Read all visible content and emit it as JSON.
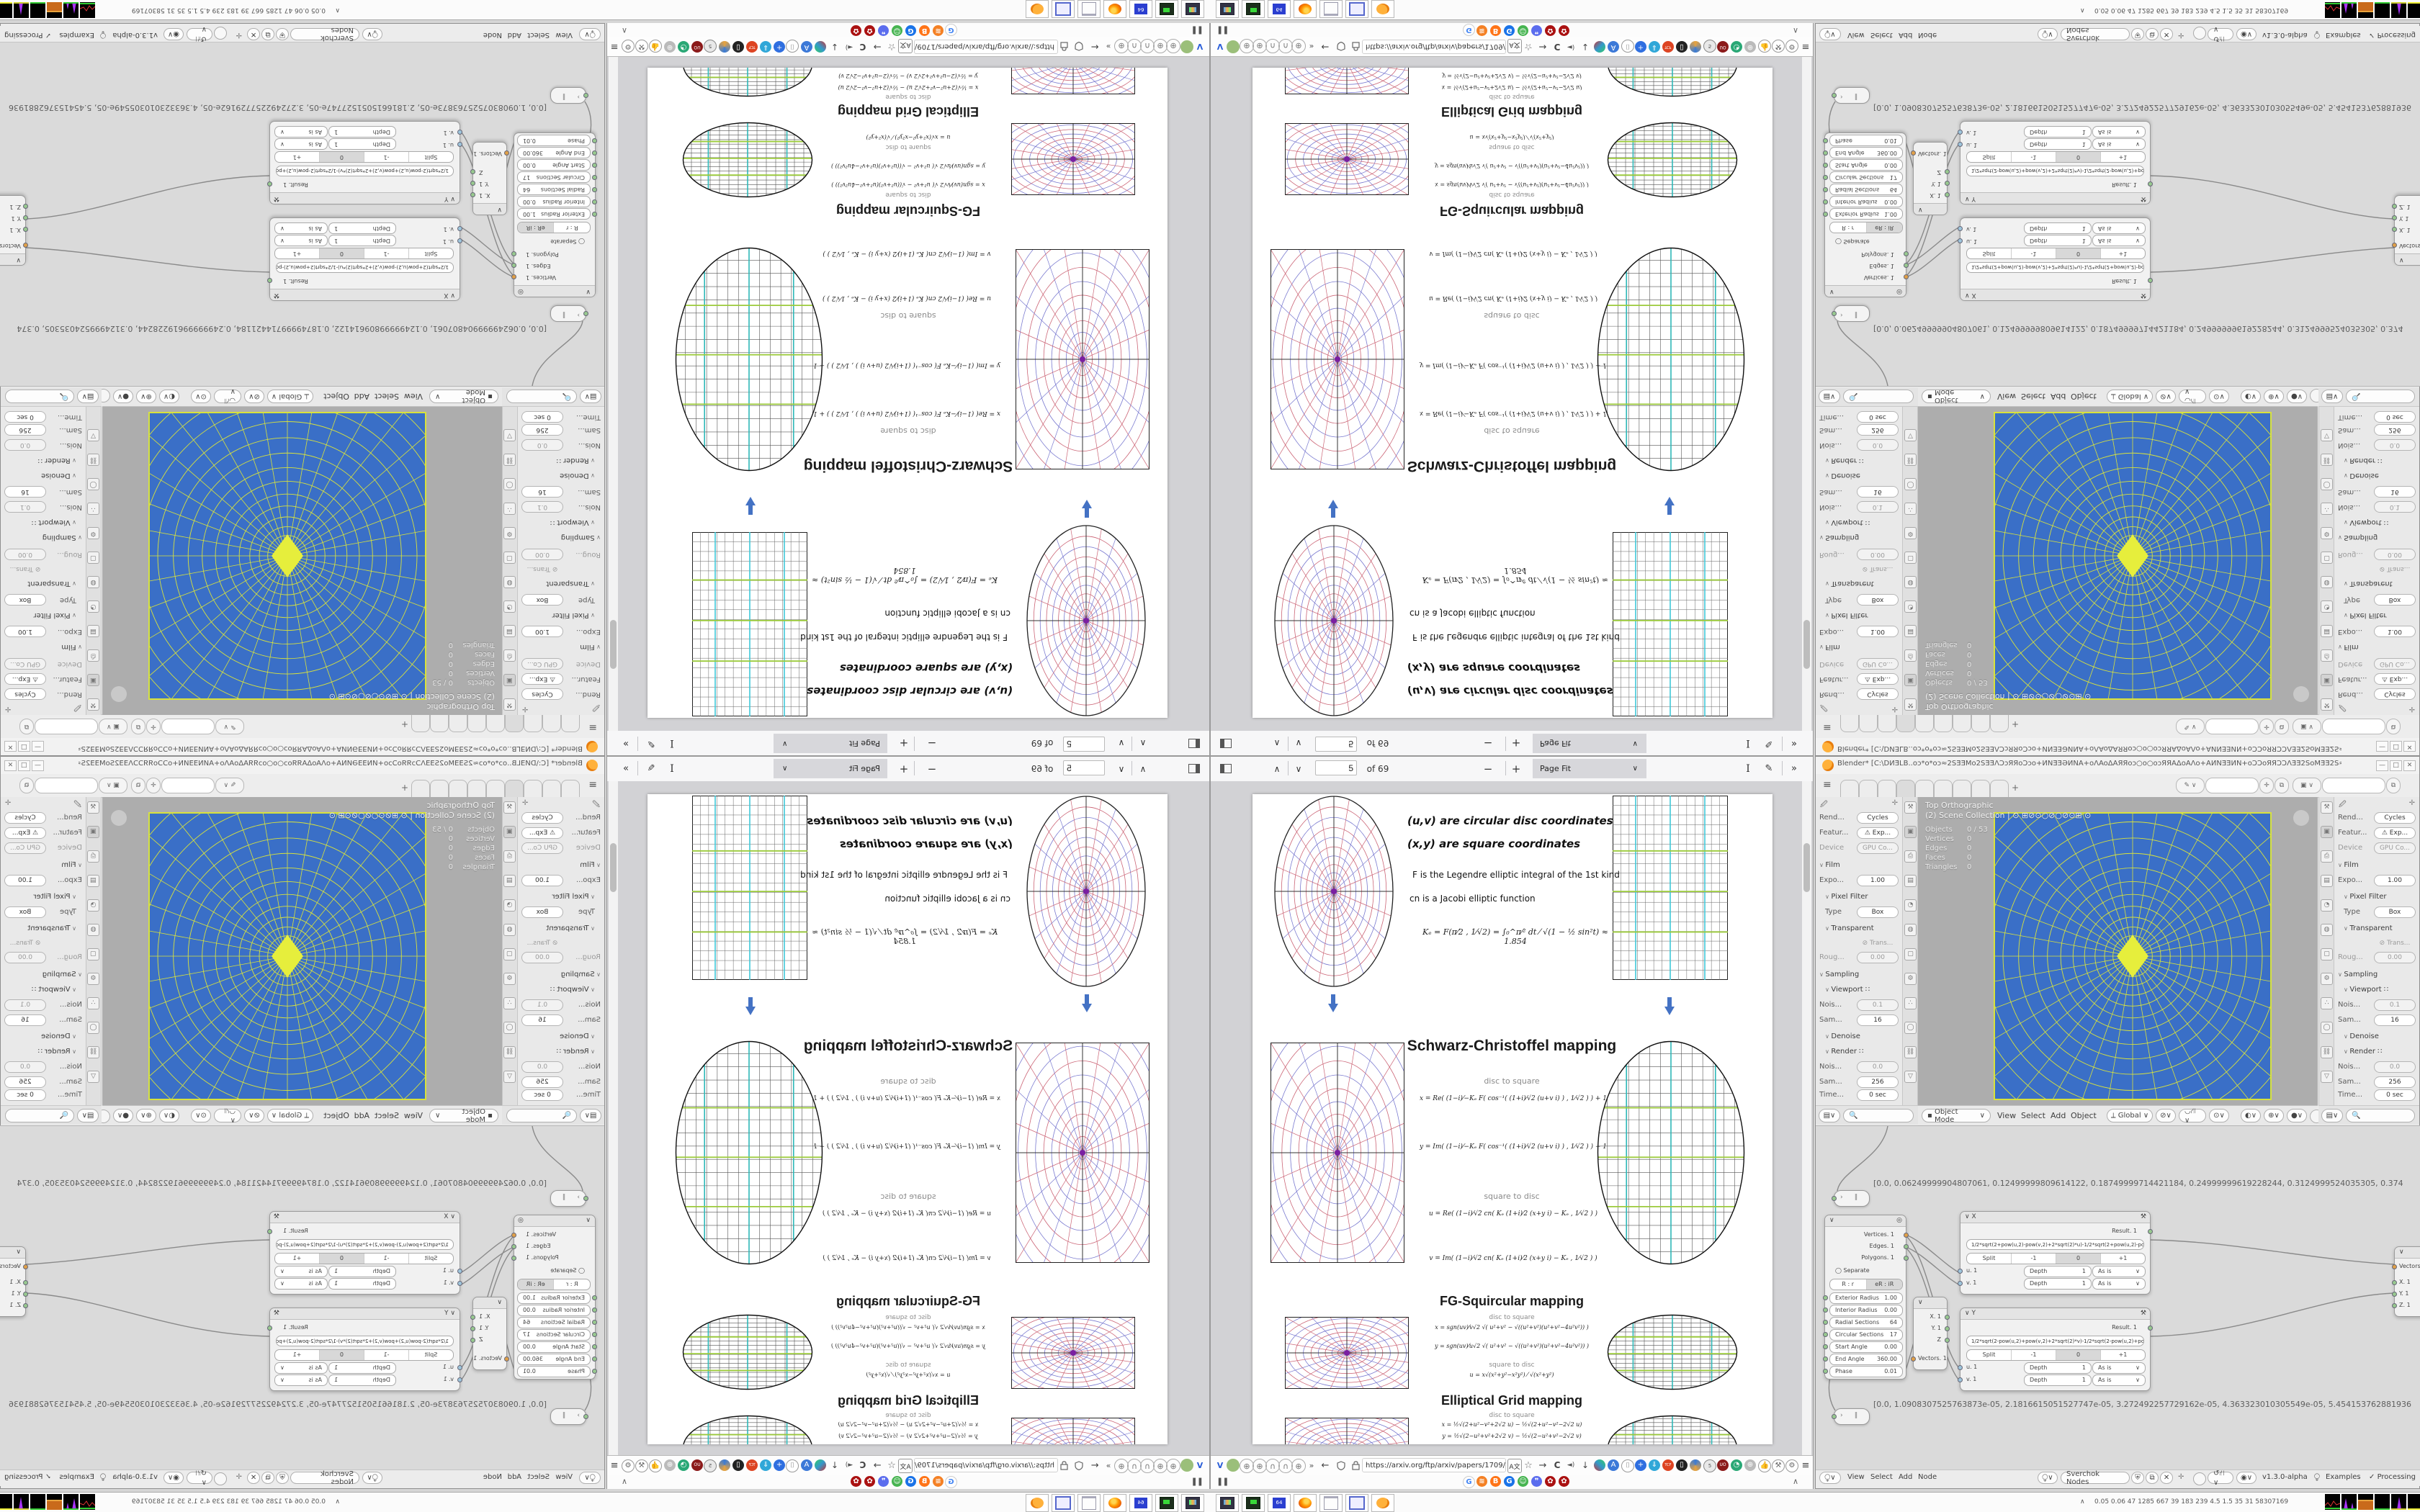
{
  "pdf": {
    "toolbar": {
      "page_value": "5",
      "page_of": "of 69",
      "zoom_value": "Page Fit",
      "minus": "−",
      "plus": "+",
      "chevron_up": "∧",
      "chevron_down": "∨",
      "more": "»",
      "text_tool": "I",
      "draw_tool": "✎"
    },
    "navbar": {
      "url": "https://arxiv.org/ftp/arxiv/papers/1709/1709",
      "back": "←",
      "forward": "→",
      "reload": "C",
      "overflow": "»",
      "menu": "≡",
      "star": "☆",
      "download": "↓",
      "speaker": "◄)"
    },
    "bookmarks": {
      "left_glyph": "❚❚",
      "collapse": "∧",
      "icons": [
        "G",
        "≋",
        "B",
        "G",
        "☺",
        "❞",
        "✿",
        "✿"
      ]
    },
    "page": {
      "uv_line": "(u,v)  are circular disc coordinates",
      "xy_line": "(x,y)  are square coordinates",
      "f_line": "F is the Legendre elliptic integral of the 1st kind",
      "cn_line": "cn is a Jacobi elliptic function",
      "ke_line": "Kₑ = F(π⁄2 , 1⁄√2) = ∫₀^π⁄²  dt ⁄ √(1 − ½ sin²t)   ≈ 1.854",
      "sc": {
        "title": "Schwarz-Christoffel mapping",
        "d2s": "disc to square",
        "fx": "x = Re( (1−i)⁄−Kₑ  F( cos⁻¹( (1+i)⁄√2 (u+v i) ) , 1⁄√2 ) ) + 1",
        "fy": "y = Im( (1−i)⁄−Kₑ  F( cos⁻¹( (1+i)⁄√2 (u+v i) ) , 1⁄√2 ) ) − 1",
        "s2d": "square to disc",
        "fu": "u = Re( (1−i)⁄√2  cn( Kₑ (1+i)⁄2 (x+y i) − Kₑ , 1⁄√2 ) )",
        "fv": "v = Im( (1−i)⁄√2  cn( Kₑ (1+i)⁄2 (x+y i) − Kₑ , 1⁄√2 ) )"
      },
      "fg": {
        "title": "FG-Squircular mapping",
        "d2s": "disc to square",
        "fx": "x = sgn(uv)⁄v√2 √( u²+v² − √((u²+v²)(u²+v²−4u²v²)) )",
        "fy": "y = sgn(uv)⁄u√2 √( u²+v² − √((u²+v²)(u²+v²−4u²v²)) )",
        "s2d": "square to disc",
        "fu": "u = x√(x²+y²−x²y²) ⁄ √(x²+y²)",
        "fv": "v = y√(x²+y²−x²y²) ⁄ √(x²+y²)"
      },
      "eg": {
        "title": "Elliptical Grid mapping",
        "d2s": "disc to square",
        "fx": "x = ½√(2+u²−v²+2√2 u) − ½√(2+u²−v²−2√2 u)",
        "fy": "y = ½√(2−u²+v²+2√2 v) − ½√(2−u²+v²−2√2 v)",
        "s2d": "square to disc",
        "fu": "u = x √(1 − y²⁄2)",
        "fv": "v = y √(1 − x²⁄2)"
      }
    }
  },
  "blender": {
    "title": "Blender* [C:\\DИƎLB..oɔ*o*oɔ≈2SƎƎMo2SƎƎΛƆɔЯЯoƆɔo+ИNƎƎƏИNA+oΛAoΔAЯЯoɔ○o○oɔЯЯAΔoAΛo+AИNƎƎИN+oƆƆoЯЯƆƆΛƎƎ2SoMƎƎ2S≈oɔ*o*o…",
    "win_min": "—",
    "win_max": "□",
    "win_close": "✕",
    "topbar": {
      "menu": "≡",
      "new_tab": "+"
    },
    "props": {
      "rows": [
        {
          "l": "Rend...",
          "v": "Cycles"
        },
        {
          "l": "Featur...",
          "v": "⚠ Exp..."
        },
        {
          "l": "Device",
          "v": "GPU Co..."
        },
        {
          "s": "Film"
        },
        {
          "l": "Expo...",
          "v": "1.00"
        },
        {
          "s": "Pixel Filter"
        },
        {
          "l": "Type",
          "v": "Box"
        },
        {
          "s": "Transparent"
        },
        {
          "l": "",
          "v": "⊘ Trans..."
        },
        {
          "l": "Roug...",
          "v": "0.00"
        },
        {
          "s": "Sampling"
        },
        {
          "s": "Viewport  ∷"
        },
        {
          "l": "Nois...",
          "v": "0.1"
        },
        {
          "l": "Sam...",
          "v": "16"
        },
        {
          "s": "Denoise"
        },
        {
          "s": "Render  ∷"
        },
        {
          "l": "Nois...",
          "v": "0.0"
        },
        {
          "l": "Sam...",
          "v": "256"
        },
        {
          "l": "Time...",
          "v": "0 sec"
        }
      ]
    },
    "viewport": {
      "mode_line": "Top Orthographic",
      "scene_line": "(2) Scene Collection | ⊙ ⊞⊘⊙○⊘○⊘⊙⊞ ⊙",
      "stats": [
        {
          "k": "Objects",
          "v": "0 / 53"
        },
        {
          "k": "Vertices",
          "v": "0"
        },
        {
          "k": "Edges",
          "v": "0"
        },
        {
          "k": "Faces",
          "v": "0"
        },
        {
          "k": "Triangles",
          "v": "0"
        }
      ],
      "header": {
        "mode": "Object Mode",
        "m1": "View",
        "m2": "Select",
        "m3": "Add",
        "m4": "Object",
        "orient": "Global"
      }
    },
    "node_editor": {
      "array_top": "[0.0, 0.06249999904807061, 0.12499999809614122, 0.18749999714421184, 0.24999999619228244, 0.3124999524035305, 0.374",
      "array_bottom": "[0.0, 1.0908307525763873e-05, 2.1816615051527747e-05, 3.272492257729162e-05, 4.363323010305549e-05, 5.454153762881936",
      "circle_node": {
        "out1": "Vertices. 1",
        "out2": "Edges. 1",
        "out3": "Polygons. 1",
        "separate": "Separate",
        "seg_a": "R : r",
        "seg_b": "eR : iR",
        "sliders": [
          {
            "l": "Exterior Radius",
            "v": "1.00"
          },
          {
            "l": "Interior Radius",
            "v": "0.00"
          },
          {
            "l": "Radial Sections",
            "v": "64"
          },
          {
            "l": "Circular Sections",
            "v": "17"
          },
          {
            "l": "Start Angle",
            "v": "0.00"
          },
          {
            "l": "End Angle",
            "v": "360.00"
          },
          {
            "l": "Phase",
            "v": "0.01"
          }
        ]
      },
      "x_node": {
        "name": "X",
        "result": "Result. 1",
        "formula": "1/2*sqrt(2+pow(u,2)-pow(v,2)+2*sqrt(2)*u)-1/2*sqrt(2+pow(u,2)-pow(v,2)-2*sqrt(2)*u)",
        "split": "Split",
        "m1": "-1",
        "zero": "0",
        "p1": "+1",
        "row_u": {
          "s": "u. 1",
          "d": "Depth",
          "dv": "1",
          "mode": "As is"
        },
        "row_v": {
          "s": "v. 1",
          "d": "Depth",
          "dv": "1",
          "mode": "As is"
        }
      },
      "y_node": {
        "name": "Y",
        "result": "Result. 1",
        "formula": "1/2*sqrt(2-pow(u,2)+pow(v,2)+2*sqrt(2)*v)-1/2*sqrt(2-pow(u,2)+pow(v,2)-2*sqrt(2)*v)",
        "split": "Split",
        "m1": "-1",
        "zero": "0",
        "p1": "+1",
        "row_u": {
          "s": "u. 1",
          "d": "Depth",
          "dv": "1",
          "mode": "As is"
        },
        "row_v": {
          "s": "v. 1",
          "d": "Depth",
          "dv": "1",
          "mode": "As is"
        }
      },
      "vec_in": {
        "r1": "X. 1",
        "r2": "Y. 1",
        "r3": "Z",
        "bottom": "Vectors. 1"
      },
      "vec_out": {
        "top": "Vectors. 1",
        "r1": "X. 1",
        "r2": "Y. 1",
        "r3": "Z. 1"
      },
      "header": {
        "m1": "View",
        "m2": "Select",
        "m3": "Add",
        "m4": "Node",
        "search": "Sverchok Nodes",
        "version": "v1.3.0-alpha",
        "examples": "Examples",
        "processing": "Processing"
      }
    }
  },
  "taskbar": {
    "tray_stats": "0.05 0.06   47   1285 667    39    183   239   4.5    1.5    35     31   58307169",
    "tray_collapse": "∧",
    "app_icons": [
      "screenshot-app-icon",
      "emulator-app-icon",
      "savestate-app-icon",
      "firefox-app-icon",
      "notepad-app-icon",
      "window-app-icon",
      "blender-app-icon"
    ],
    "floppy_label": "64"
  },
  "colors": {
    "accent_blue": "#4472c4",
    "render_blue": "#3a6fc7",
    "render_yellow": "#d8e23c",
    "grid_green": "#9ccb3b",
    "grid_cyan": "#3fc8d8",
    "fig_blue": "#7a7ad0",
    "fig_red": "#cc6677",
    "fig_purple": "#8a2be2"
  }
}
